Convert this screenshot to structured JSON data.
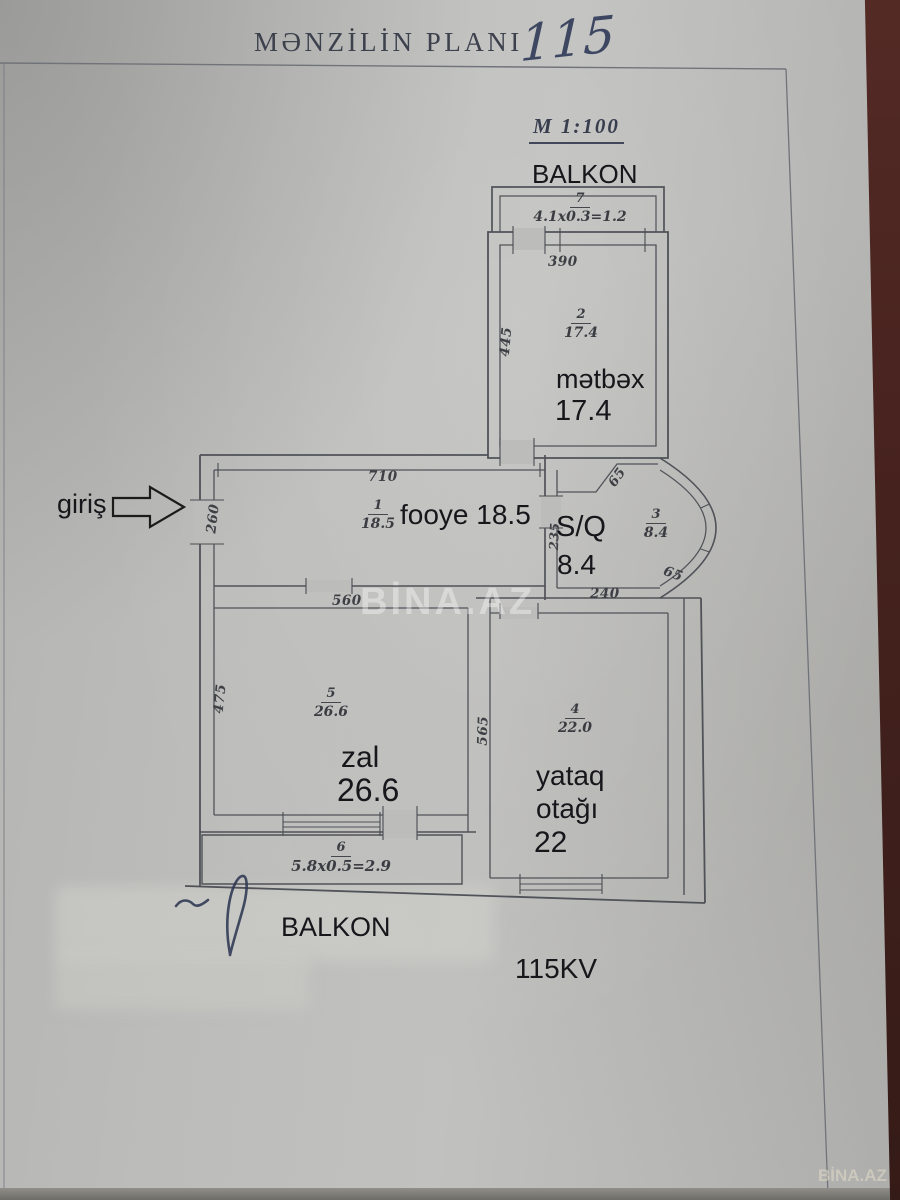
{
  "header": {
    "title": "MƏNZİLİN PLANI",
    "handwritten": "115",
    "scale": "M 1:100"
  },
  "labels": {
    "entrance": "giriş",
    "balkon_top": "BALKON",
    "balkon_bottom": "BALKON",
    "footer": "115KV"
  },
  "rooms": {
    "balkon7": {
      "num": "7",
      "formula": "4.1x0.3=1.2"
    },
    "kitchen": {
      "num": "2",
      "frac_area": "17.4",
      "name": "mətbəx",
      "area": "17.4"
    },
    "foyer": {
      "num": "1",
      "frac_area": "18.5",
      "name": "fooye 18.5"
    },
    "sq": {
      "num": "3",
      "frac_area": "8.4",
      "name": "S/Q",
      "area": "8.4"
    },
    "zal": {
      "num": "5",
      "frac_area": "26.6",
      "name": "zal",
      "area": "26.6"
    },
    "bedroom": {
      "num": "4",
      "frac_area": "22.0",
      "name1": "yataq",
      "name2": "otağı",
      "area": "22"
    },
    "balkon6": {
      "num": "6",
      "formula": "5.8x0.5=2.9"
    }
  },
  "dims": {
    "kitchen_w": "390",
    "kitchen_h": "445",
    "foyer_w": "710",
    "entrance_door": "260",
    "sq_left": "235",
    "sq_bottom": "240",
    "sq_chamfer_top": "65",
    "sq_chamfer_bottom": "65",
    "zal_w": "560",
    "zal_h": "475",
    "bedroom_h": "565"
  },
  "watermarks": {
    "center": "BİNA.AZ",
    "corner": "BİNA.AZ"
  }
}
